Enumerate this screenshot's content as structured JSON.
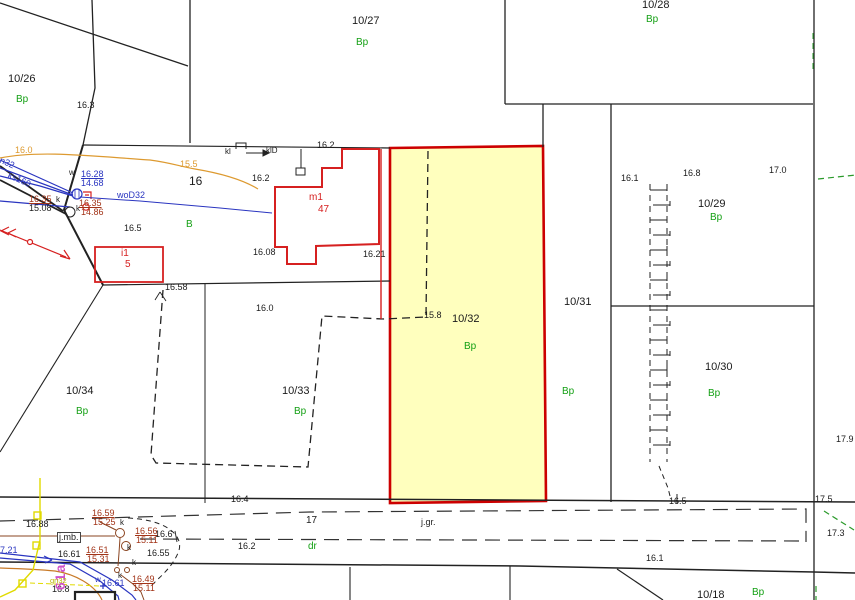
{
  "map": {
    "type": "cadastral-base-plan",
    "highlighted_parcel": "10/32",
    "road_parcel": "17",
    "colors": {
      "highlight_fill": "#ffffbe",
      "highlight_border": "#cc0000",
      "land_use_green": "#14a014",
      "benchmark_darkred": "#a23418",
      "utility_blue": "#2a35c0",
      "contour_orange": "#dd9a30",
      "utility_yellow": "#e0da00",
      "utility_brown": "#8a4420",
      "annotation_magenta": "#cf52c9",
      "building_red": "#d62020",
      "line_black": "#222222",
      "green_dashed": "#2a9a2a"
    }
  },
  "labels": [
    {
      "t": "10/26",
      "x": 8,
      "y": 74,
      "c": "p"
    },
    {
      "t": "10/27",
      "x": 352,
      "y": 16,
      "c": "p"
    },
    {
      "t": "10/28",
      "x": 642,
      "y": 0,
      "c": "p"
    },
    {
      "t": "10/29",
      "x": 698,
      "y": 199,
      "c": "p"
    },
    {
      "t": "10/30",
      "x": 705,
      "y": 362,
      "c": "p"
    },
    {
      "t": "10/31",
      "x": 564,
      "y": 297,
      "c": "p"
    },
    {
      "t": "10/32",
      "x": 452,
      "y": 314,
      "c": "p"
    },
    {
      "t": "10/33",
      "x": 282,
      "y": 386,
      "c": "p"
    },
    {
      "t": "10/34",
      "x": 66,
      "y": 386,
      "c": "p"
    },
    {
      "t": "10/18",
      "x": 697,
      "y": 590,
      "c": "p"
    },
    {
      "t": "17",
      "x": 306,
      "y": 516,
      "c": "p",
      "s": 10
    },
    {
      "t": "16",
      "x": 189,
      "y": 175,
      "c": "p",
      "s": 12
    },
    {
      "t": "Bp",
      "x": 16,
      "y": 95,
      "c": "g"
    },
    {
      "t": "Bp",
      "x": 356,
      "y": 38,
      "c": "g"
    },
    {
      "t": "Bp",
      "x": 646,
      "y": 15,
      "c": "g"
    },
    {
      "t": "Bp",
      "x": 710,
      "y": 213,
      "c": "g"
    },
    {
      "t": "Bp",
      "x": 708,
      "y": 389,
      "c": "g"
    },
    {
      "t": "Bp",
      "x": 562,
      "y": 387,
      "c": "g"
    },
    {
      "t": "Bp",
      "x": 464,
      "y": 342,
      "c": "g"
    },
    {
      "t": "Bp",
      "x": 294,
      "y": 407,
      "c": "g"
    },
    {
      "t": "Bp",
      "x": 76,
      "y": 407,
      "c": "g"
    },
    {
      "t": "Bp",
      "x": 752,
      "y": 588,
      "c": "g"
    },
    {
      "t": "dr",
      "x": 308,
      "y": 542,
      "c": "g"
    },
    {
      "t": "B",
      "x": 186,
      "y": 220,
      "c": "g"
    },
    {
      "t": "16.3",
      "x": 77,
      "y": 101,
      "c": "e"
    },
    {
      "t": "16.5",
      "x": 124,
      "y": 224,
      "c": "e"
    },
    {
      "t": "16.58",
      "x": 165,
      "y": 283,
      "c": "e"
    },
    {
      "t": "16.0",
      "x": 256,
      "y": 304,
      "c": "e"
    },
    {
      "t": "16.2",
      "x": 317,
      "y": 141,
      "c": "e"
    },
    {
      "t": "16.2",
      "x": 252,
      "y": 174,
      "c": "e"
    },
    {
      "t": "16.08",
      "x": 253,
      "y": 248,
      "c": "e"
    },
    {
      "t": "16.21",
      "x": 363,
      "y": 250,
      "c": "e"
    },
    {
      "t": "15.8",
      "x": 424,
      "y": 311,
      "c": "e"
    },
    {
      "t": "16.1",
      "x": 621,
      "y": 174,
      "c": "e"
    },
    {
      "t": "16.8",
      "x": 683,
      "y": 169,
      "c": "e"
    },
    {
      "t": "17.0",
      "x": 769,
      "y": 166,
      "c": "e"
    },
    {
      "t": "17.9",
      "x": 836,
      "y": 435,
      "c": "e"
    },
    {
      "t": "16.4",
      "x": 231,
      "y": 495,
      "c": "e"
    },
    {
      "t": "16.5",
      "x": 669,
      "y": 497,
      "c": "e"
    },
    {
      "t": "17.5",
      "x": 815,
      "y": 495,
      "c": "e"
    },
    {
      "t": "17.3",
      "x": 827,
      "y": 529,
      "c": "e"
    },
    {
      "t": "16.1",
      "x": 646,
      "y": 554,
      "c": "e"
    },
    {
      "t": "16.2",
      "x": 238,
      "y": 542,
      "c": "e"
    },
    {
      "t": "j.gr.",
      "x": 421,
      "y": 518,
      "c": "e",
      "n": "surface-label-jgr"
    },
    {
      "t": "16.88",
      "x": 26,
      "y": 520,
      "c": "e"
    },
    {
      "t": "16.61",
      "x": 58,
      "y": 550,
      "c": "e"
    },
    {
      "t": "16.55",
      "x": 147,
      "y": 549,
      "c": "e"
    },
    {
      "t": "16.6",
      "x": 155,
      "y": 530,
      "c": "e"
    },
    {
      "t": "16.8",
      "x": 52,
      "y": 585,
      "c": "e"
    },
    {
      "t": "15.08",
      "x": 29,
      "y": 204,
      "c": "e"
    },
    {
      "t": "j.mb.",
      "x": 57,
      "y": 532,
      "c": "x",
      "n": "surface-label-jmb"
    },
    {
      "t": "kl",
      "x": 225,
      "y": 148,
      "c": "k",
      "n": "utility-label-kl"
    },
    {
      "t": "klD",
      "x": 266,
      "y": 147,
      "c": "k",
      "n": "utility-label-klD"
    },
    {
      "t": "w",
      "x": 69,
      "y": 169,
      "c": "k"
    },
    {
      "t": "k",
      "x": 56,
      "y": 196,
      "c": "k"
    },
    {
      "t": "k",
      "x": 76,
      "y": 205,
      "c": "k"
    },
    {
      "t": "k",
      "x": 120,
      "y": 519,
      "c": "k"
    },
    {
      "t": "k",
      "x": 127,
      "y": 544,
      "c": "k"
    },
    {
      "t": "k",
      "x": 132,
      "y": 559,
      "c": "k"
    },
    {
      "t": "k",
      "x": 118,
      "y": 572,
      "c": "k"
    },
    {
      "t": "16.28",
      "x": 81,
      "y": 170,
      "c": "b",
      "u": 1
    },
    {
      "t": "14.68",
      "x": 81,
      "y": 179,
      "c": "b"
    },
    {
      "t": "woD32",
      "x": 117,
      "y": 191,
      "c": "b"
    },
    {
      "t": "n32",
      "x": 2,
      "y": 156,
      "c": "b",
      "r": 24
    },
    {
      "t": "ks160",
      "x": 10,
      "y": 171,
      "c": "b",
      "r": 24
    },
    {
      "t": "7.21",
      "x": 0,
      "y": 546,
      "c": "b"
    },
    {
      "t": "w",
      "x": 95,
      "y": 576,
      "c": "b",
      "s": 8
    },
    {
      "t": "16.61",
      "x": 102,
      "y": 579,
      "c": "b"
    },
    {
      "t": "16.35",
      "x": 29,
      "y": 195,
      "c": "d",
      "u": 1
    },
    {
      "t": "16.35",
      "x": 79,
      "y": 199,
      "c": "d",
      "u": 1
    },
    {
      "t": "14.86",
      "x": 81,
      "y": 208,
      "c": "d"
    },
    {
      "t": "16.59",
      "x": 92,
      "y": 509,
      "c": "d",
      "u": 1
    },
    {
      "t": "15.25",
      "x": 93,
      "y": 518,
      "c": "d"
    },
    {
      "t": "16.56",
      "x": 135,
      "y": 527,
      "c": "d",
      "u": 1
    },
    {
      "t": "15.11",
      "x": 136,
      "y": 536,
      "c": "d"
    },
    {
      "t": "16.51",
      "x": 86,
      "y": 546,
      "c": "d",
      "u": 1
    },
    {
      "t": "15.31",
      "x": 87,
      "y": 555,
      "c": "d"
    },
    {
      "t": "16.49",
      "x": 132,
      "y": 575,
      "c": "d",
      "u": 1
    },
    {
      "t": "15.11",
      "x": 133,
      "y": 584,
      "c": "d"
    },
    {
      "t": "16.0",
      "x": 15,
      "y": 146,
      "c": "o"
    },
    {
      "t": "15.5",
      "x": 180,
      "y": 160,
      "c": "o"
    },
    {
      "t": "m1",
      "x": 309,
      "y": 193,
      "c": "r",
      "s": 10
    },
    {
      "t": "47",
      "x": 318,
      "y": 205,
      "c": "r",
      "s": 10
    },
    {
      "t": "i1",
      "x": 121,
      "y": 249,
      "c": "r",
      "s": 10
    },
    {
      "t": "5",
      "x": 125,
      "y": 260,
      "c": "r",
      "s": 10
    },
    {
      "t": "61a",
      "x": 53,
      "y": 590,
      "c": "m",
      "r": -90
    },
    {
      "t": "gn32",
      "x": 50,
      "y": 577,
      "c": "v"
    }
  ]
}
